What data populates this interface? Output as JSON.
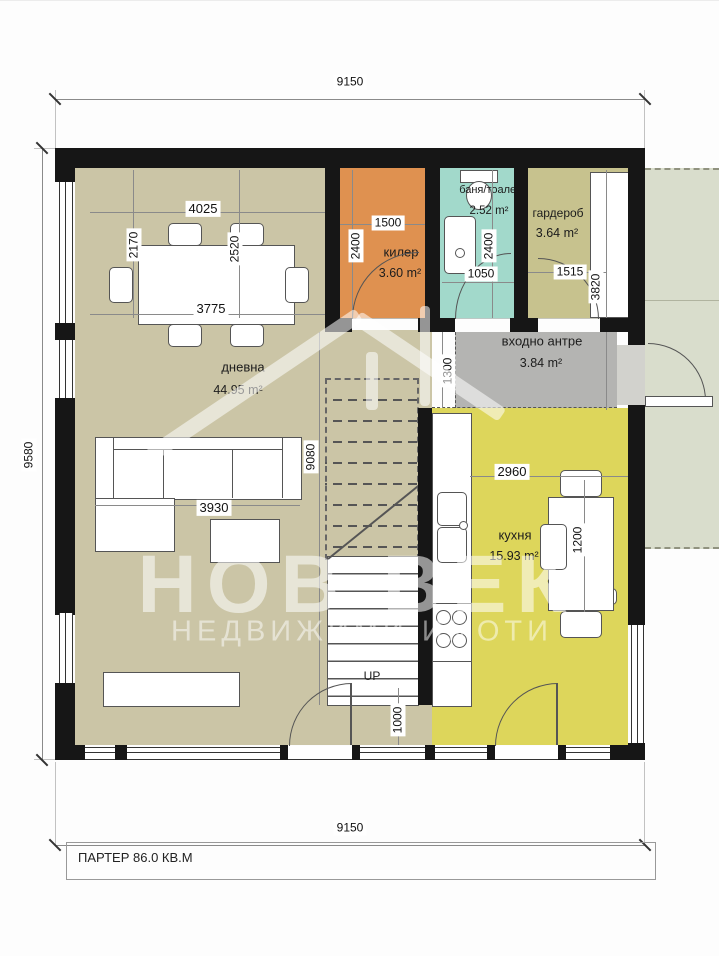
{
  "title": {
    "floor_label": "ПАРТЕР 86.0 КВ.М"
  },
  "watermark": {
    "line1": "НОВ ВЕК",
    "line2": "НЕДВИЖИМИ ИМОТИ"
  },
  "stairs": {
    "direction_label": "UP"
  },
  "rooms": {
    "living": {
      "name": "дневна",
      "area": "44.95 m²"
    },
    "pantry": {
      "name": "килер",
      "area": "3.60 m²"
    },
    "bathroom": {
      "name": "баня/тоалет",
      "area": "2.52 m²"
    },
    "wardrobe": {
      "name": "гардероб",
      "area": "3.64 m²"
    },
    "hall": {
      "name": "входно антре",
      "area": "3.84 m²"
    },
    "kitchen": {
      "name": "кухня",
      "area": "15.93 m²"
    }
  },
  "dimensions": {
    "overall_width_top": "9150",
    "overall_height_left": "9580",
    "overall_width_bottom": "9150",
    "dining_width": "4025",
    "dining_depth_left": "2170",
    "dining_table_span": "2520",
    "dining_width_bottom": "3775",
    "pantry_width": "1500",
    "pantry_depth": "2400",
    "bathroom_depth": "2400",
    "bathroom_door": "1050",
    "wardrobe_width": "1515",
    "wardrobe_hall_depth": "3820",
    "hall_depth": "1300",
    "living_length": "9080",
    "sofa_length": "3930",
    "terrace_door": "1000",
    "kitchen_width": "2960",
    "kitchen_table_length": "1200"
  },
  "colors": {
    "wall": "#161616",
    "living": "#cbc5a6",
    "pantry": "#df9150",
    "bathroom": "#a2d9cb",
    "wardrobe": "#c7c28e",
    "hall": "#b4b4b2",
    "kitchen": "#ddd65b",
    "terrace": "#d9ddcc",
    "watermark": "rgba(255,255,255,0.55)"
  }
}
